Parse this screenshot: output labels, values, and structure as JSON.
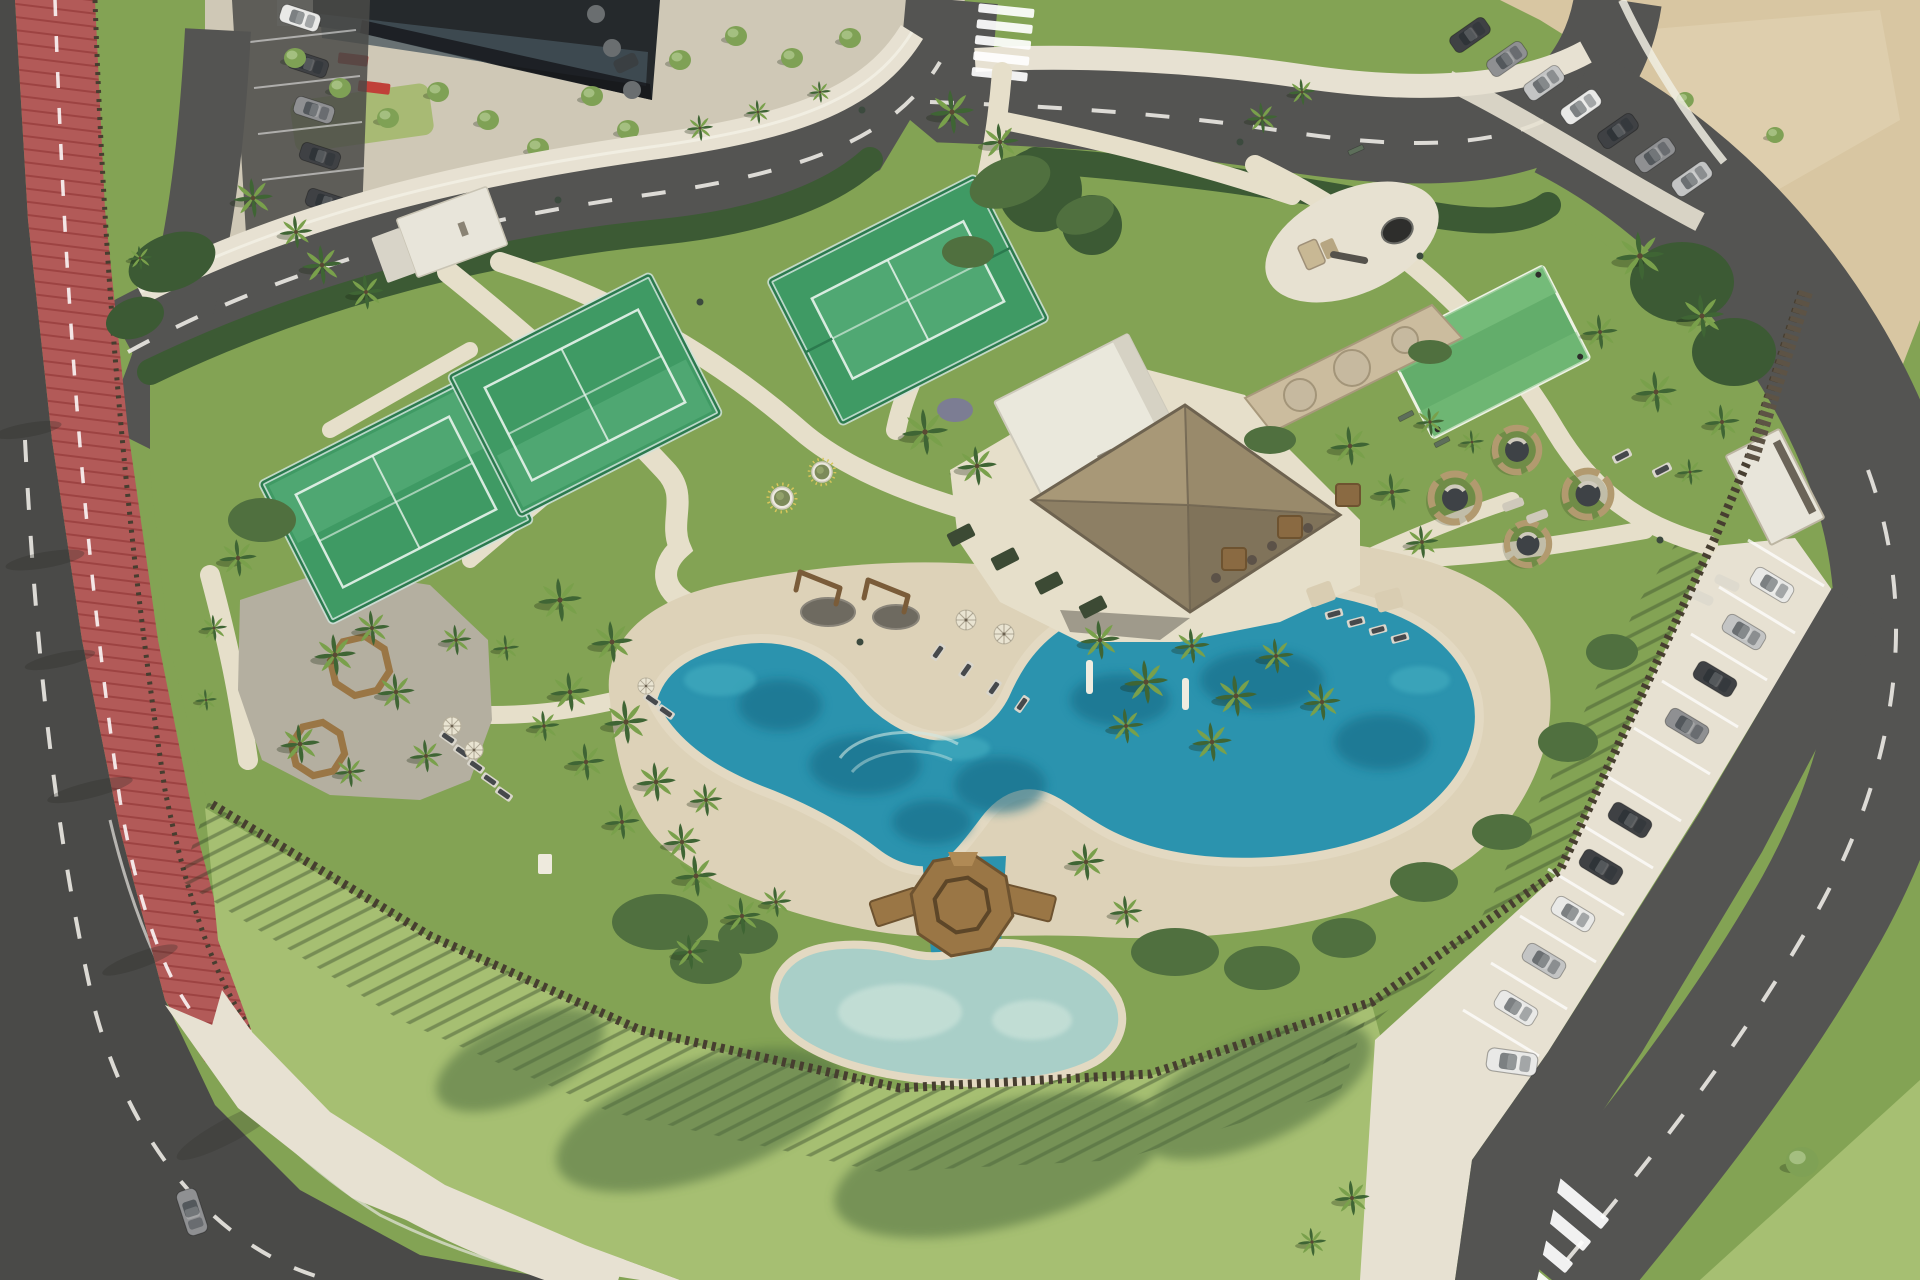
{
  "meta": {
    "title": "Aerial render - beachfront resort amenity park",
    "type": "3d-aerial-render",
    "dimensions": "1920x1280"
  },
  "palette": {
    "asphalt": "#545452",
    "asphalt_dark": "#4a4a48",
    "lane_mark": "#eceae4",
    "track_red": "#b25a58",
    "track_red_light": "#c26e66",
    "sidewalk": "#e7e1d2",
    "path": "#e6dfca",
    "plaza": "#cfc8b6",
    "curb_white": "#f0ede2",
    "sand_beach": "#ddd2b8",
    "sand_lot": "#d8c6a2",
    "grass": "#83a354",
    "grass_light": "#9db764",
    "grass_dark": "#66874a",
    "lawn_south": "#a6bf72",
    "lawn_shadow": "#4f6e40",
    "hedge": "#3c5a34",
    "shrub": "#50703f",
    "palm_dark": "#3f6534",
    "palm_light": "#79a04b",
    "tree_green": "#7fa155",
    "court_turf": "#3f9a64",
    "court_turf_light": "#5cb27d",
    "court_frame": "#2b7a4e",
    "court_glass": "#cfe3da",
    "court_line": "#e8f4ec",
    "minicourt": "#63ad6b",
    "pool_deep": "#176a85",
    "pool_mid": "#2b93ae",
    "pool_light": "#49b4c4",
    "pool_shallow": "#a5d8d8",
    "pool_sand": "#e0d6bd",
    "kids_pool": "#a9cfc8",
    "kids_pool_light": "#c9e2d9",
    "deck_wood": "#9a7645",
    "deck_dark": "#6e5330",
    "thatch": "#a39375",
    "thatch_shadow": "#7e7259",
    "building_white": "#eae8dc",
    "building_dark": "#25292c",
    "building_glass": "#46545c",
    "kiosk": "#e8e5da",
    "stone_wall": "#cbbc9e",
    "boulder": "#c6b99f",
    "fence_wood": "#473e30",
    "gravel": "#b4afa0",
    "playground_pad": "#e7e1d1",
    "play_equip": "#c8b894",
    "trampoline": "#2e2e2c",
    "umbrella": "#e9e4d2",
    "umbrella_tan": "#d9cdb2",
    "umbrella_gray": "#6a6e70",
    "lounger_dark": "#46494c",
    "lounger_frame": "#d9d6cc",
    "pod_wicker": "#b29a6f",
    "pod_seat": "#3e4246",
    "car_white": "#e9e9e7",
    "car_silver": "#c3c4c4",
    "car_gray": "#8f9092",
    "car_dark": "#3f4144",
    "car_red": "#b23730",
    "tree_shadow": "#4e6d3f"
  },
  "scene": {
    "amenities": [
      {
        "id": "padel-courts",
        "count": 3
      },
      {
        "id": "lagoon-pool",
        "count": 1
      },
      {
        "id": "kids-pool",
        "count": 1
      },
      {
        "id": "octagon-deck-gazebo",
        "count": 1
      },
      {
        "id": "thatched-pavilion",
        "count": 1
      },
      {
        "id": "playground",
        "count": 1
      },
      {
        "id": "outdoor-gym",
        "count": 1
      },
      {
        "id": "picnic-grove-octagon-benches",
        "count": 2
      },
      {
        "id": "wicker-lounge-pods",
        "count": 4
      },
      {
        "id": "multisport-turf",
        "count": 1
      },
      {
        "id": "running-track",
        "count": 1
      },
      {
        "id": "street-parking",
        "count": 1
      },
      {
        "id": "sand-parking-lot",
        "count": 1
      }
    ],
    "counts": {
      "palm_trees": 49,
      "cars_visible": 26,
      "sun_loungers": 19,
      "umbrellas": 10,
      "crosswalks": 2
    }
  }
}
